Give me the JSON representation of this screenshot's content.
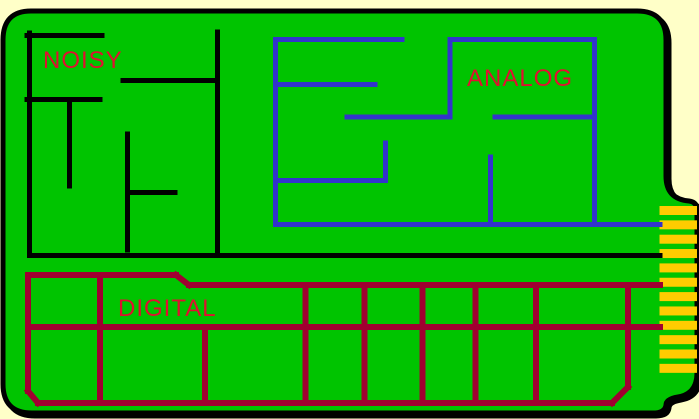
{
  "colors": {
    "background": "#FFFFC8",
    "board": "#00C400",
    "outline": "#000000",
    "label": "#E01030",
    "finger": "#FFCC00"
  },
  "board": {
    "outline_path": "M 31 11 H 637 Q 666 11 666 40 V 176 Q 666 199 689 201 Q 697 202 697 210 V 373 Q 697 394 678 397 Q 666 399 666 405 Q 665 413 653 413 H 32 Q 3 413 3 384 V 40 Q 3 11 31 11 Z",
    "outline_width": 5,
    "shadow_dx": 3,
    "shadow_dy": 3
  },
  "connector": {
    "finger_count": 12,
    "x": 659.5,
    "width": 37.5,
    "y_start": 206,
    "pitch": 14.35,
    "finger_height": 9
  },
  "regions": {
    "noisy": {
      "label": "NOISY",
      "label_x": 43,
      "label_y": 68,
      "trace_color": "#000000",
      "stroke_width": 5,
      "segments": [
        [
          29.5,
          33,
          29.5,
          255.5
        ],
        [
          27,
          35.5,
          102,
          35.5
        ],
        [
          27,
          99.5,
          100,
          99.5
        ],
        [
          69.5,
          99.5,
          69.5,
          186
        ],
        [
          123,
          80.5,
          217.5,
          80.5
        ],
        [
          217.5,
          32,
          217.5,
          255.5
        ],
        [
          127.5,
          134,
          127.5,
          250
        ],
        [
          127.5,
          192.5,
          175,
          192.5
        ],
        [
          29.5,
          255.5,
          660,
          255.5
        ]
      ]
    },
    "analog": {
      "label": "ANALOG",
      "label_x": 467,
      "label_y": 86,
      "trace_color": "#3333CC",
      "stroke_width": 5,
      "segments": [
        [
          275.5,
          39.5,
          402,
          39.5
        ],
        [
          275.5,
          39.5,
          275.5,
          224.5
        ],
        [
          275.5,
          84.5,
          375,
          84.5
        ],
        [
          347,
          117,
          450,
          117
        ],
        [
          450,
          39.5,
          450,
          117
        ],
        [
          450,
          39.5,
          594.5,
          39.5
        ],
        [
          594.5,
          39.5,
          594.5,
          224.5
        ],
        [
          495,
          117,
          594.5,
          117
        ],
        [
          275.5,
          224.5,
          660,
          224.5
        ],
        [
          490.5,
          157,
          490.5,
          224.5
        ],
        [
          385.5,
          143,
          385.5,
          180.5
        ],
        [
          277,
          180.5,
          385.5,
          180.5
        ]
      ]
    },
    "digital": {
      "label": "DIGITAL",
      "label_x": 118,
      "label_y": 316,
      "trace_color": "#A00030",
      "stroke_width": 6,
      "segments": [
        [
          28,
          275,
          176,
          275
        ],
        [
          176,
          275,
          189,
          285
        ],
        [
          189,
          285,
          660,
          285
        ],
        [
          28,
          275,
          28,
          391
        ],
        [
          28,
          391,
          38,
          403
        ],
        [
          38,
          403,
          612,
          403
        ],
        [
          612,
          403,
          628,
          387
        ],
        [
          628,
          285,
          628,
          387
        ],
        [
          28,
          327,
          660,
          327
        ],
        [
          100,
          275,
          100,
          403
        ],
        [
          205,
          327,
          205,
          403
        ],
        [
          305.5,
          285,
          305.5,
          403
        ],
        [
          364.5,
          285,
          364.5,
          403
        ],
        [
          422.5,
          285,
          422.5,
          403
        ],
        [
          475.5,
          285,
          475.5,
          403
        ],
        [
          536,
          285,
          536,
          403
        ]
      ]
    }
  }
}
